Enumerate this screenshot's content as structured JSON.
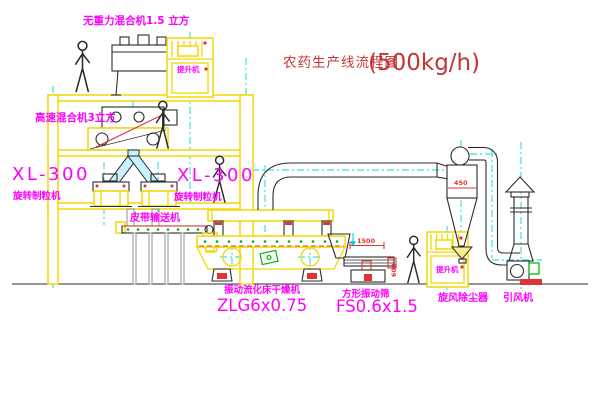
{
  "colors": {
    "cad_yellow": "#f2d800",
    "magenta": "#ff00ff",
    "red": "#e03434",
    "title_red": "#c53434",
    "cyan": "#00d8d8",
    "green": "#00b400",
    "line_dark": "#2b2b2b",
    "gray": "#8f949a",
    "background": "#ffffff"
  },
  "title": {
    "text": "农药生产线流程图",
    "capacity": "(500kg/h)"
  },
  "labels": {
    "gravity_mixer": "无重力混合机1.5 立方",
    "high_speed_mixer": "高速混合机3立方",
    "xl300_left": "XL-300",
    "xl300_left_sub": "旋转制粒机",
    "xl300_mid": "XL-300",
    "xl300_mid_sub": "旋转制粒机",
    "belt_conveyor": "皮带输送机",
    "dryer_name": "振动流化床干燥机",
    "dryer_model": "ZLG6x0.75",
    "screen_name": "方形振动筛",
    "screen_model": "FS0.6x1.5",
    "cyclone": "旋风除尘器",
    "fan": "引风机",
    "elevator_top": "提升机",
    "elevator_right": "提升机"
  },
  "dims": {
    "screen_length": "1500",
    "screen_width": "600",
    "cyclone_diameter": "450"
  }
}
